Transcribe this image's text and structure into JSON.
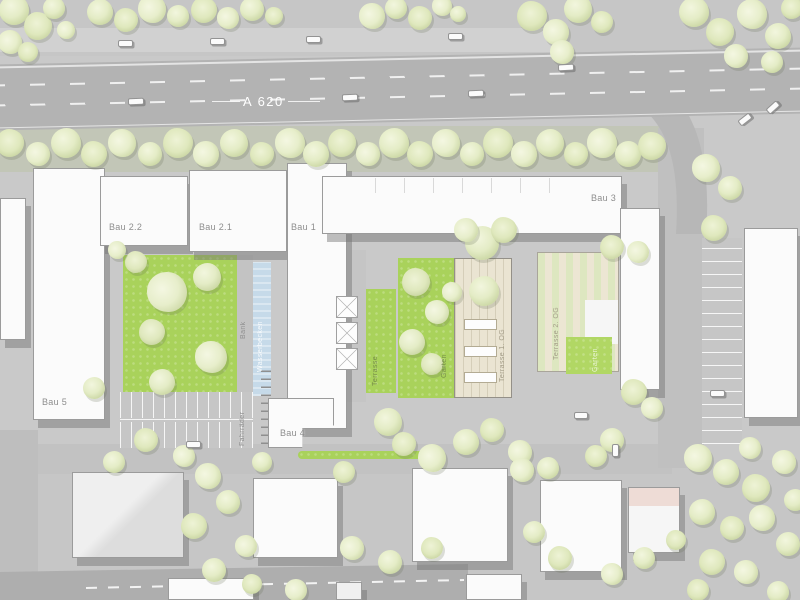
{
  "plan": {
    "highway_label": "A 620",
    "buildings": {
      "bau5": "Bau 5",
      "bau22": "Bau 2.2",
      "bau21": "Bau 2.1",
      "bau1": "Bau 1",
      "bau3": "Bau 3",
      "bau4": "Bau 4"
    },
    "labels": {
      "bank": "Bank",
      "wasserbecken": "Wasserbecken",
      "fahrraeder": "Fahrräder",
      "terrasse": "Terrasse",
      "terrasse1": "Terrasse 1. OG",
      "terrasse2": "Terrasse 2. OG",
      "garten1": "Garten",
      "garten2": "Garten"
    },
    "colors": {
      "lawn": "#a9d25b",
      "water": "#c6dae9",
      "tree": "#e4ecc6",
      "highway": "#b3b3b3",
      "building": "#fbfbfb",
      "terrace": "#eae4d2",
      "label_text": "#8d8d8d",
      "highway_text": "#ffffff"
    },
    "trees": [
      [
        14,
        10,
        15
      ],
      [
        38,
        26,
        14
      ],
      [
        10,
        42,
        12
      ],
      [
        54,
        8,
        11
      ],
      [
        28,
        52,
        10
      ],
      [
        66,
        30,
        9
      ],
      [
        100,
        12,
        13
      ],
      [
        126,
        20,
        12
      ],
      [
        152,
        9,
        14
      ],
      [
        178,
        16,
        11
      ],
      [
        204,
        10,
        13
      ],
      [
        228,
        18,
        11
      ],
      [
        252,
        9,
        12
      ],
      [
        274,
        16,
        9
      ],
      [
        372,
        16,
        13
      ],
      [
        396,
        8,
        11
      ],
      [
        420,
        18,
        12
      ],
      [
        442,
        6,
        10
      ],
      [
        458,
        14,
        8
      ],
      [
        532,
        16,
        15
      ],
      [
        556,
        32,
        13
      ],
      [
        578,
        9,
        14
      ],
      [
        602,
        22,
        11
      ],
      [
        562,
        52,
        12
      ],
      [
        694,
        12,
        15
      ],
      [
        720,
        32,
        14
      ],
      [
        752,
        14,
        15
      ],
      [
        778,
        36,
        13
      ],
      [
        792,
        8,
        11
      ],
      [
        736,
        56,
        12
      ],
      [
        772,
        62,
        11
      ],
      [
        10,
        143,
        14
      ],
      [
        38,
        154,
        12
      ],
      [
        66,
        143,
        15
      ],
      [
        94,
        154,
        13
      ],
      [
        122,
        143,
        14
      ],
      [
        150,
        154,
        12
      ],
      [
        178,
        143,
        15
      ],
      [
        206,
        154,
        13
      ],
      [
        234,
        143,
        14
      ],
      [
        262,
        154,
        12
      ],
      [
        290,
        143,
        15
      ],
      [
        316,
        154,
        13
      ],
      [
        342,
        143,
        14
      ],
      [
        368,
        154,
        12
      ],
      [
        394,
        143,
        15
      ],
      [
        420,
        154,
        13
      ],
      [
        446,
        143,
        14
      ],
      [
        472,
        154,
        12
      ],
      [
        498,
        143,
        15
      ],
      [
        524,
        154,
        13
      ],
      [
        550,
        143,
        14
      ],
      [
        576,
        154,
        12
      ],
      [
        602,
        143,
        15
      ],
      [
        628,
        154,
        13
      ],
      [
        652,
        146,
        14
      ],
      [
        706,
        168,
        14
      ],
      [
        730,
        188,
        12
      ],
      [
        714,
        228,
        13
      ],
      [
        167,
        292,
        20
      ],
      [
        207,
        277,
        14
      ],
      [
        152,
        332,
        13
      ],
      [
        211,
        357,
        16
      ],
      [
        162,
        382,
        13
      ],
      [
        136,
        262,
        11
      ],
      [
        117,
        250,
        9
      ],
      [
        94,
        388,
        11
      ],
      [
        146,
        440,
        12
      ],
      [
        184,
        456,
        11
      ],
      [
        114,
        462,
        11
      ],
      [
        416,
        282,
        14
      ],
      [
        437,
        312,
        12
      ],
      [
        412,
        342,
        13
      ],
      [
        432,
        364,
        11
      ],
      [
        452,
        292,
        10
      ],
      [
        482,
        243,
        17
      ],
      [
        504,
        230,
        13
      ],
      [
        466,
        230,
        12
      ],
      [
        484,
        291,
        15
      ],
      [
        612,
        247,
        12
      ],
      [
        638,
        252,
        11
      ],
      [
        388,
        422,
        14
      ],
      [
        404,
        444,
        12
      ],
      [
        432,
        458,
        14
      ],
      [
        466,
        442,
        13
      ],
      [
        492,
        430,
        12
      ],
      [
        520,
        452,
        12
      ],
      [
        548,
        468,
        11
      ],
      [
        634,
        392,
        13
      ],
      [
        652,
        408,
        11
      ],
      [
        612,
        440,
        12
      ],
      [
        596,
        456,
        11
      ],
      [
        208,
        476,
        13
      ],
      [
        228,
        502,
        12
      ],
      [
        194,
        526,
        13
      ],
      [
        246,
        546,
        11
      ],
      [
        214,
        570,
        12
      ],
      [
        252,
        584,
        10
      ],
      [
        296,
        590,
        11
      ],
      [
        262,
        462,
        10
      ],
      [
        344,
        472,
        11
      ],
      [
        352,
        548,
        12
      ],
      [
        390,
        562,
        12
      ],
      [
        432,
        548,
        11
      ],
      [
        522,
        470,
        12
      ],
      [
        534,
        532,
        11
      ],
      [
        560,
        558,
        12
      ],
      [
        612,
        574,
        11
      ],
      [
        644,
        558,
        11
      ],
      [
        676,
        540,
        10
      ],
      [
        698,
        458,
        14
      ],
      [
        726,
        472,
        13
      ],
      [
        756,
        488,
        14
      ],
      [
        784,
        462,
        12
      ],
      [
        702,
        512,
        13
      ],
      [
        732,
        528,
        12
      ],
      [
        762,
        518,
        13
      ],
      [
        788,
        544,
        12
      ],
      [
        712,
        562,
        13
      ],
      [
        746,
        572,
        12
      ],
      [
        778,
        592,
        11
      ],
      [
        698,
        590,
        11
      ],
      [
        750,
        448,
        11
      ],
      [
        795,
        500,
        11
      ]
    ],
    "cars": [
      [
        118,
        40,
        15,
        7,
        0
      ],
      [
        210,
        38,
        15,
        7,
        0
      ],
      [
        306,
        36,
        15,
        7,
        0
      ],
      [
        448,
        33,
        15,
        7,
        0
      ],
      [
        128,
        98,
        16,
        7,
        -2
      ],
      [
        342,
        94,
        16,
        7,
        -2
      ],
      [
        468,
        90,
        16,
        7,
        -2
      ],
      [
        558,
        64,
        16,
        7,
        -3
      ],
      [
        738,
        116,
        14,
        7,
        -38
      ],
      [
        766,
        104,
        14,
        7,
        -42
      ],
      [
        186,
        441,
        15,
        7,
        0
      ],
      [
        574,
        412,
        14,
        7,
        0
      ],
      [
        612,
        444,
        7,
        13,
        0
      ],
      [
        710,
        390,
        15,
        7,
        0
      ]
    ]
  }
}
